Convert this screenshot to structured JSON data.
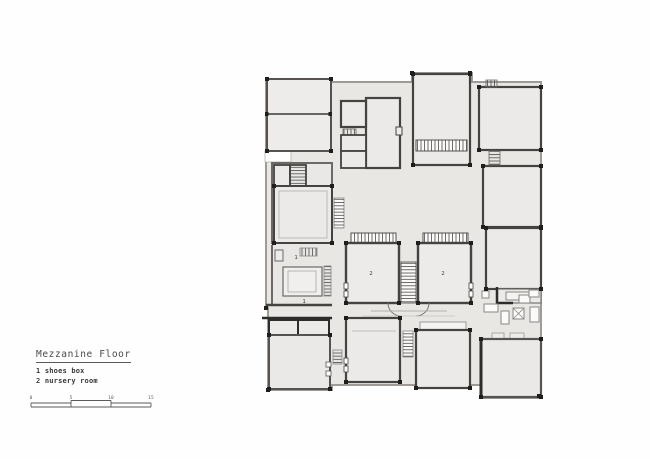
{
  "title_block": {
    "title": "Mezzanine Floor",
    "legend": [
      {
        "number": "1",
        "name": "shoes box",
        "text": "1 shoes box"
      },
      {
        "number": "2",
        "name": "nursery room",
        "text": "2 nursery room"
      }
    ]
  },
  "scale_bar": {
    "units": "meters",
    "ticks": [
      {
        "label": "0"
      },
      {
        "label": "5"
      },
      {
        "label": "10"
      },
      {
        "label": "15"
      }
    ]
  },
  "plan": {
    "name": "mezzanine floor plan",
    "room_labels": [
      {
        "room": "shoes box upper",
        "text": "1"
      },
      {
        "room": "shoes box lower",
        "text": "1"
      },
      {
        "room": "nursery room left",
        "text": "2"
      },
      {
        "room": "nursery room right",
        "text": "2"
      }
    ],
    "colors": {
      "floor": "#e8e7e4",
      "room_fill": "#edecea",
      "wall_dark": "#45423f",
      "wall_light": "#9b9895",
      "column": "#1f1e1d",
      "hatch": "#4a4a4a",
      "deck_fill": "#fbfaf9"
    }
  }
}
